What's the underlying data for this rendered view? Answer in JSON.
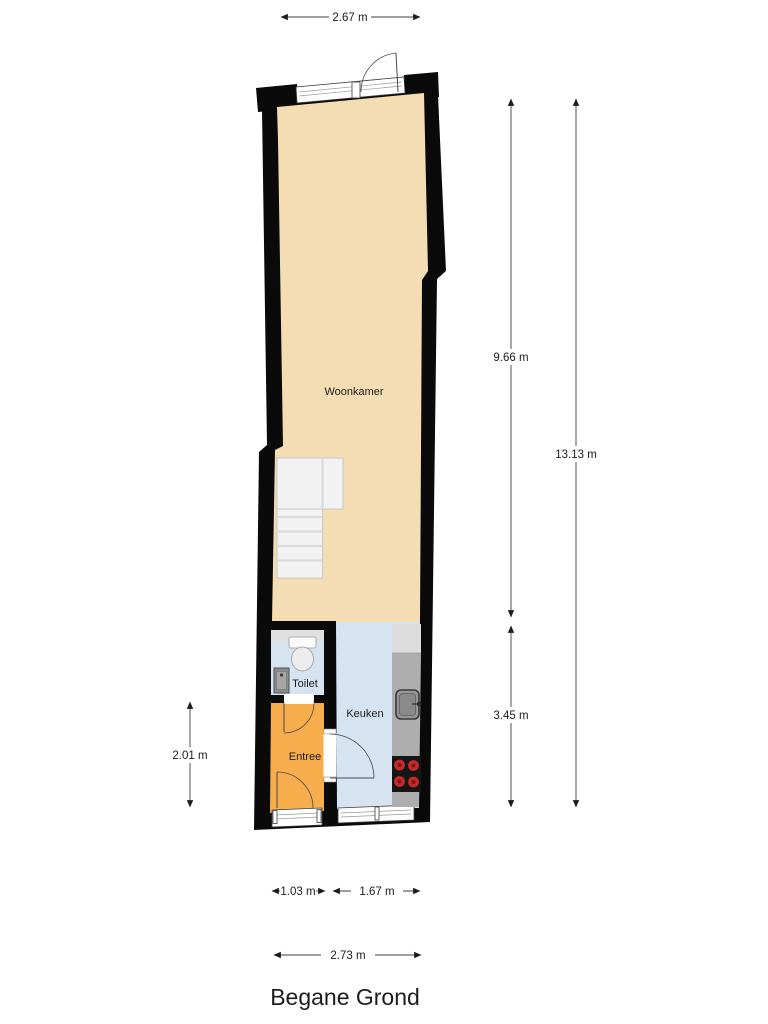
{
  "plan_title": "Begane Grond",
  "rooms": [
    {
      "name": "woonkamer",
      "label": "Woonkamer"
    },
    {
      "name": "toilet",
      "label": "Toilet"
    },
    {
      "name": "keuken",
      "label": "Keuken"
    },
    {
      "name": "entree",
      "label": "Entree"
    }
  ],
  "dimensions": {
    "top_width": "2.67 m",
    "right_upper": "9.66 m",
    "right_lower": "3.45 m",
    "right_total": "13.13 m",
    "left_entree": "2.01 m",
    "bottom_entree": "1.03 m",
    "bottom_keuken": "1.67 m",
    "bottom_total": "2.73 m"
  },
  "fixtures": [
    "stairs",
    "toilet-bowl",
    "hand-basin",
    "kitchen-counter",
    "kitchen-sink",
    "cooktop"
  ],
  "colors": {
    "floor_wood": "#F4DDB2",
    "floor_tile": "#D6E3F0",
    "floor_entree": "#F7AD4C",
    "wall": "#0a0a0a",
    "counter": "#AEAEAE",
    "counter_light": "#DCDCDC",
    "toilet_shelf": "#E0E0E0",
    "burner_red": "#C42B2B"
  }
}
